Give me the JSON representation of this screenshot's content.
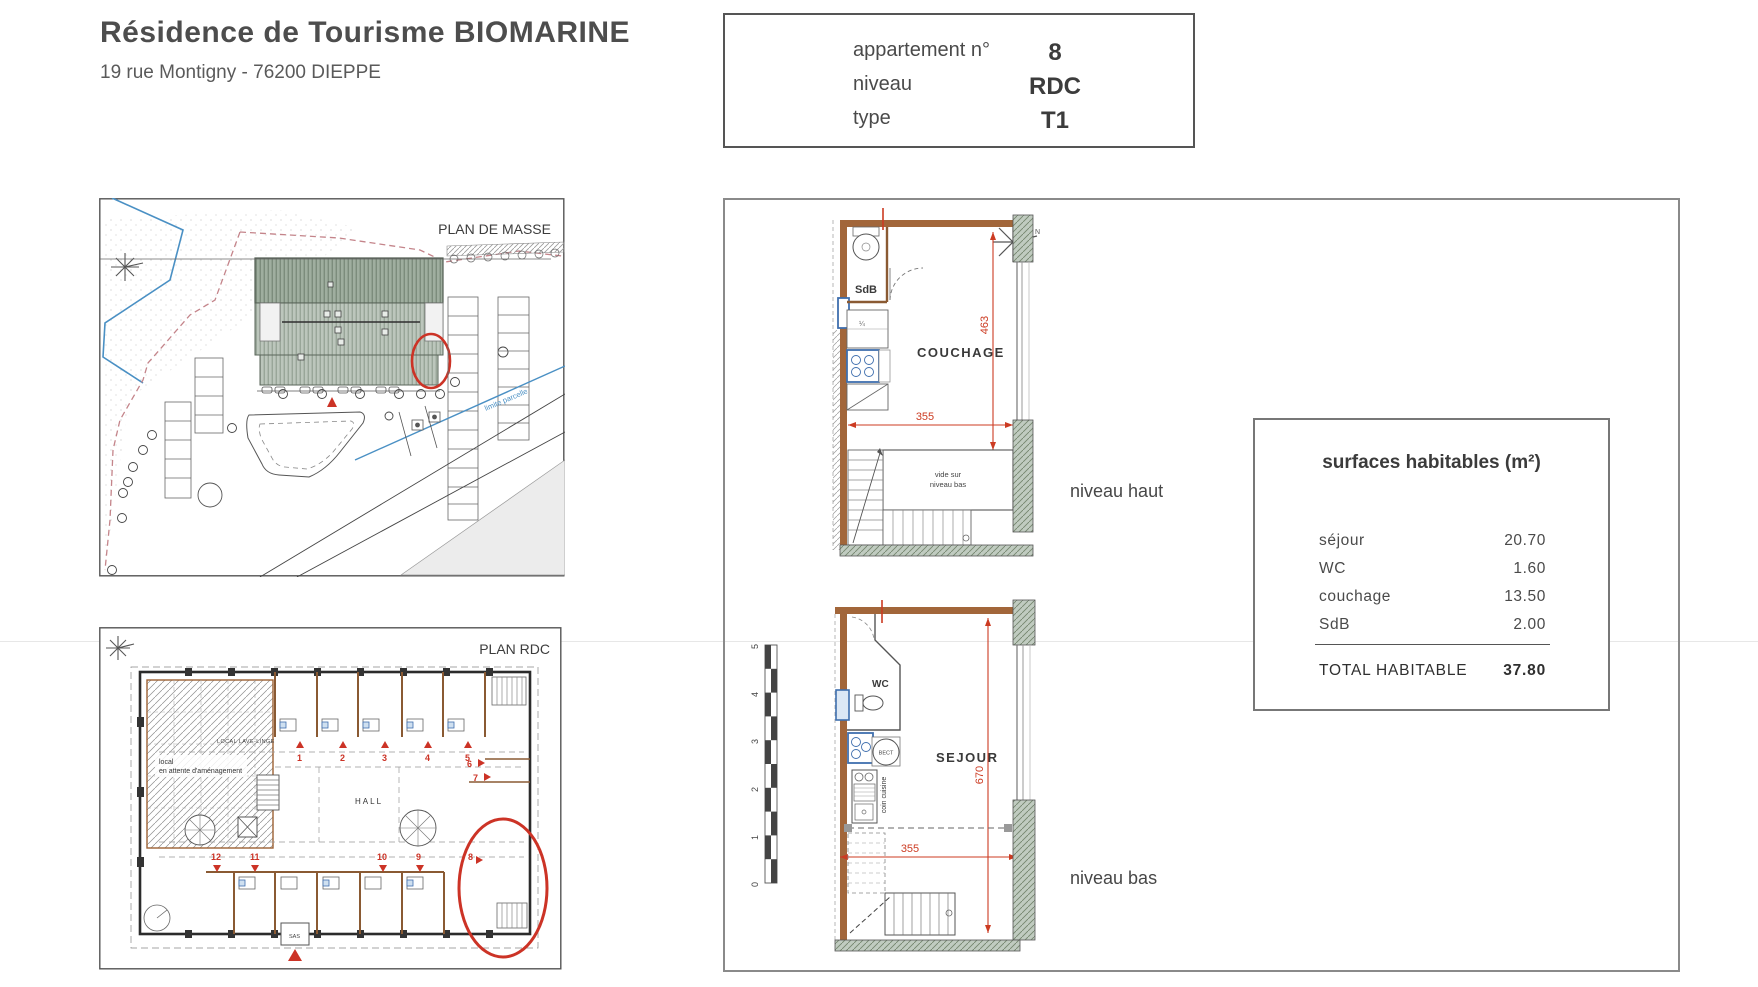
{
  "header": {
    "title": "Résidence de Tourisme BIOMARINE",
    "address": "19 rue Montigny - 76200 DIEPPE"
  },
  "info_box": {
    "rows": [
      {
        "label": "appartement n°",
        "value": "8"
      },
      {
        "label": "niveau",
        "value": "RDC"
      },
      {
        "label": "type",
        "value": "T1"
      }
    ]
  },
  "site_plan": {
    "title": "PLAN DE MASSE",
    "boundary_label": "limite parcelle"
  },
  "floor_plan": {
    "title": "PLAN RDC",
    "hall": "HALL",
    "pending_room_line1": "local",
    "pending_room_line2": "en attente d'aménagement",
    "laundry": "LOCAL LAVE-LINGE",
    "sas": "SAS",
    "units_top": [
      "1",
      "2",
      "3",
      "4",
      "5",
      "6",
      "7"
    ],
    "units_bottom": [
      "12",
      "11",
      "10",
      "9",
      "8"
    ]
  },
  "upper_level": {
    "label": "niveau haut",
    "bathroom": "SdB",
    "bedroom": "COUCHAGE",
    "void_line1": "vide sur",
    "void_line2": "niveau bas",
    "dim_width": "355",
    "dim_height": "463"
  },
  "lower_level": {
    "label": "niveau bas",
    "wc": "WC",
    "living": "SEJOUR",
    "kitchen": "coin cuisine",
    "heater": "BECT",
    "dim_width": "355",
    "dim_height": "670",
    "scale_ticks": [
      "5",
      "4",
      "3",
      "2",
      "1",
      "0"
    ]
  },
  "areas_table": {
    "title": "surfaces habitables (m²)",
    "rows": [
      {
        "label": "séjour",
        "value": "20.70"
      },
      {
        "label": "WC",
        "value": "1.60"
      },
      {
        "label": "couchage",
        "value": "13.50"
      },
      {
        "label": "SdB",
        "value": "2.00"
      }
    ],
    "total_label": "TOTAL  HABITABLE",
    "total_value": "37.80"
  },
  "colors": {
    "wall_brown": "#9c6134",
    "dim_red": "#cc3b22",
    "mark_red": "#cc3326",
    "water_blue": "#4a90c4",
    "boundary_pink": "#c4848a",
    "roof_green": "#9fae9f",
    "fixture_blue": "#3f6fae"
  }
}
